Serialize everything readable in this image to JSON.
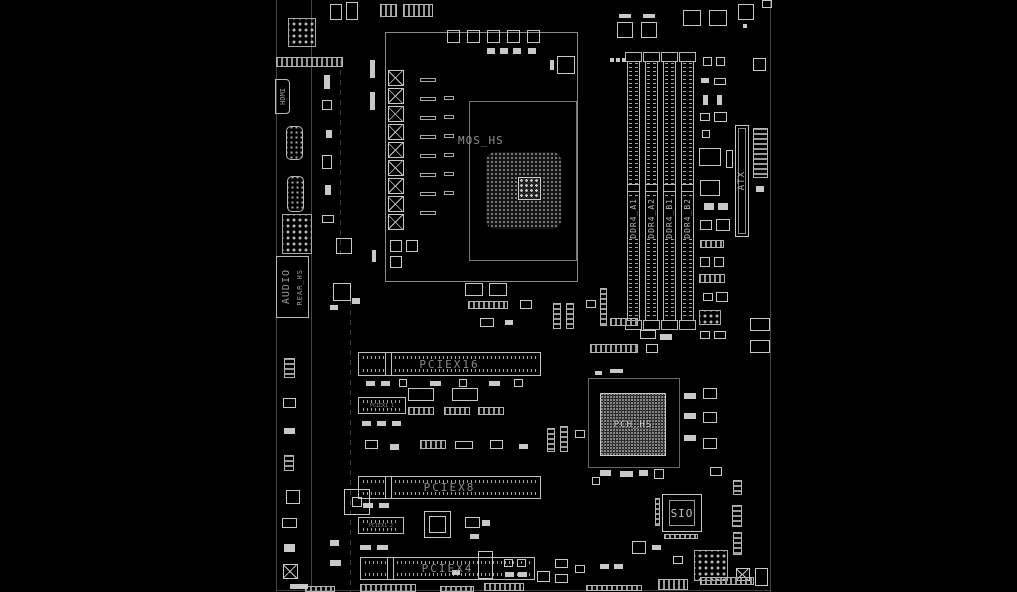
{
  "board": {
    "background": "#000000",
    "line_color": "#c8c8c8",
    "label_color": "#8f8f8f"
  },
  "labels": {
    "mos_hs": "MOS_HS",
    "pch_hs": "PCH_HS",
    "sio": "SIO",
    "atx": "ATX",
    "hdmi": "HDMI",
    "audio": "AUDIO",
    "rear_hs": "REAR_HS",
    "pciex16": "PCIEX16",
    "pciex8": "PCIEX8",
    "pciex4": "PCIEX4",
    "pciex1_1": "PCIEX1_1",
    "pciex1_2": "PCIEX1_2"
  },
  "dimm_slots": [
    {
      "label": "DDR4_A1"
    },
    {
      "label": "DDR4_A2"
    },
    {
      "label": "DDR4_B1"
    },
    {
      "label": "DDR4_B2"
    }
  ]
}
